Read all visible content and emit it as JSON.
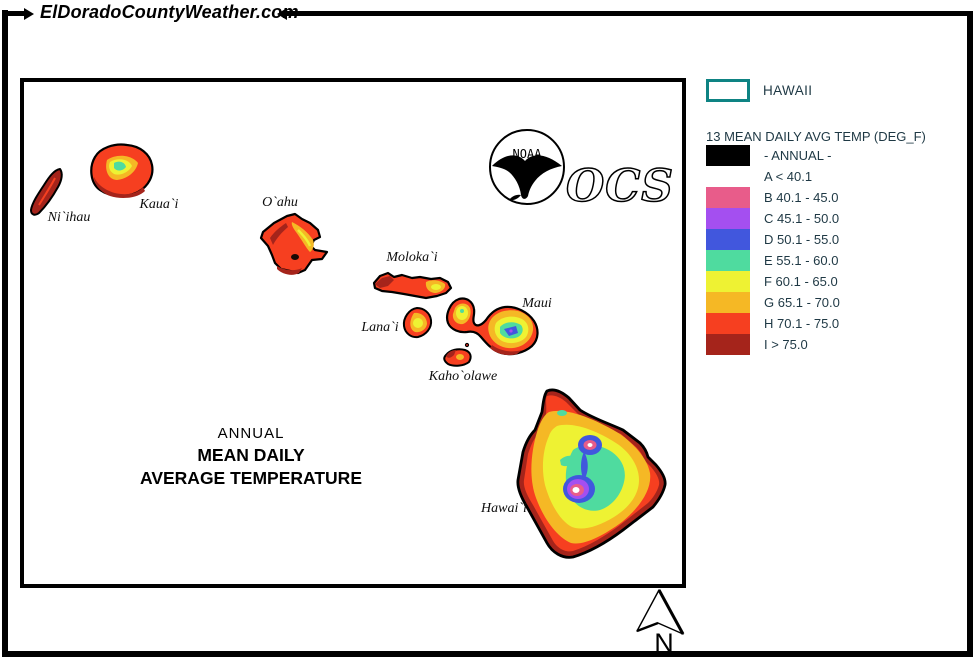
{
  "site": {
    "banner_title": "ElDoradoCountyWeather.com"
  },
  "map": {
    "island_labels": [
      "Ni`ihau",
      "Kaua`i",
      "O`ahu",
      "Moloka`i",
      "Lana`i",
      "Maui",
      "Kaho`olawe",
      "Hawai`i"
    ],
    "title_line1": "ANNUAL",
    "title_line2": "MEAN DAILY",
    "title_line3": "AVERAGE TEMPERATURE",
    "noaa_text": "NOAA",
    "ocs_text": "OCS",
    "north_label": "N"
  },
  "legend": {
    "region_label": "HAWAII",
    "region_box_color": "#0e8383",
    "title": "13 MEAN DAILY AVG TEMP (DEG_F)",
    "entries": [
      {
        "label": "- ANNUAL -",
        "swatch": "#000000"
      },
      {
        "label": "A < 40.1",
        "swatch": null
      },
      {
        "label": "B 40.1 - 45.0",
        "swatch": "#e85c8a"
      },
      {
        "label": "C 45.1 - 50.0",
        "swatch": "#a44ff0"
      },
      {
        "label": "D 50.1 - 55.0",
        "swatch": "#4157dd"
      },
      {
        "label": "E 55.1 - 60.0",
        "swatch": "#4fdb9f"
      },
      {
        "label": "F 60.1 - 65.0",
        "swatch": "#eef233"
      },
      {
        "label": "G 65.1 - 70.0",
        "swatch": "#f5b825"
      },
      {
        "label": "H 70.1 - 75.0",
        "swatch": "#f63f20"
      },
      {
        "label": "I > 75.0",
        "swatch": "#a5241b"
      }
    ]
  },
  "palette": {
    "A": "#ffffff",
    "B": "#e85c8a",
    "C": "#a44ff0",
    "D": "#4157dd",
    "E": "#4fdb9f",
    "F": "#eef233",
    "G": "#f5b825",
    "H": "#f63f20",
    "I": "#a5241b",
    "outline": "#000000"
  }
}
